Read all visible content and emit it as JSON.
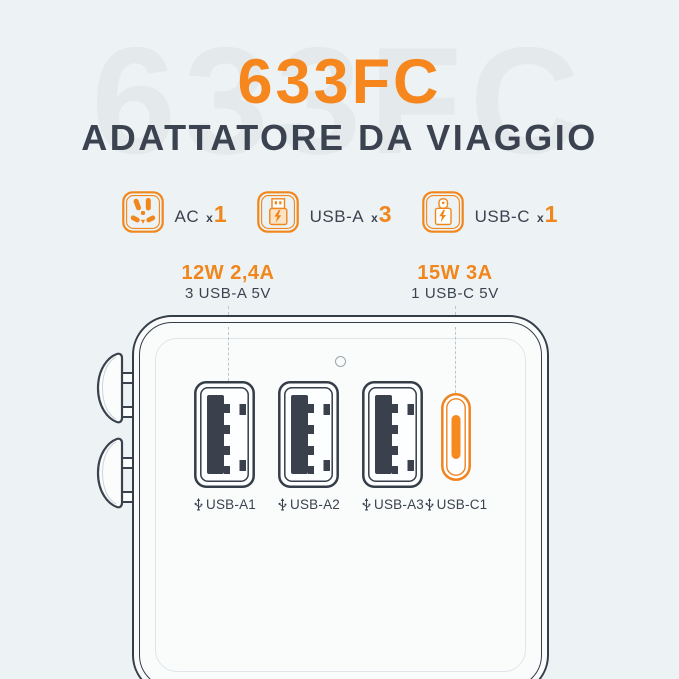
{
  "colors": {
    "background": "#edf3f4",
    "accent_orange": "#f1861c",
    "title_orange": "#f6871f",
    "dark_slate": "#3b4350"
  },
  "header": {
    "watermark": "633FC",
    "model": "633FC",
    "subtitle": "ADATTATORE DA VIAGGIO"
  },
  "features": [
    {
      "icon": "ac-outlet-icon",
      "label": "AC",
      "times": "x",
      "count": "1"
    },
    {
      "icon": "usb-a-icon",
      "label": "USB-A",
      "times": "x",
      "count": "3"
    },
    {
      "icon": "usb-c-icon",
      "label": "USB-C",
      "times": "x",
      "count": "1"
    }
  ],
  "callouts": {
    "usb_a": {
      "power": "12W 2,4A",
      "detail": "3 USB-A 5V"
    },
    "usb_c": {
      "power": "15W 3A",
      "detail": "1 USB-C 5V"
    }
  },
  "device": {
    "ports": [
      {
        "type": "usb-a",
        "label": "USB-A1"
      },
      {
        "type": "usb-a",
        "label": "USB-A2"
      },
      {
        "type": "usb-a",
        "label": "USB-A3"
      },
      {
        "type": "usb-c",
        "label": "USB-C1"
      }
    ]
  }
}
